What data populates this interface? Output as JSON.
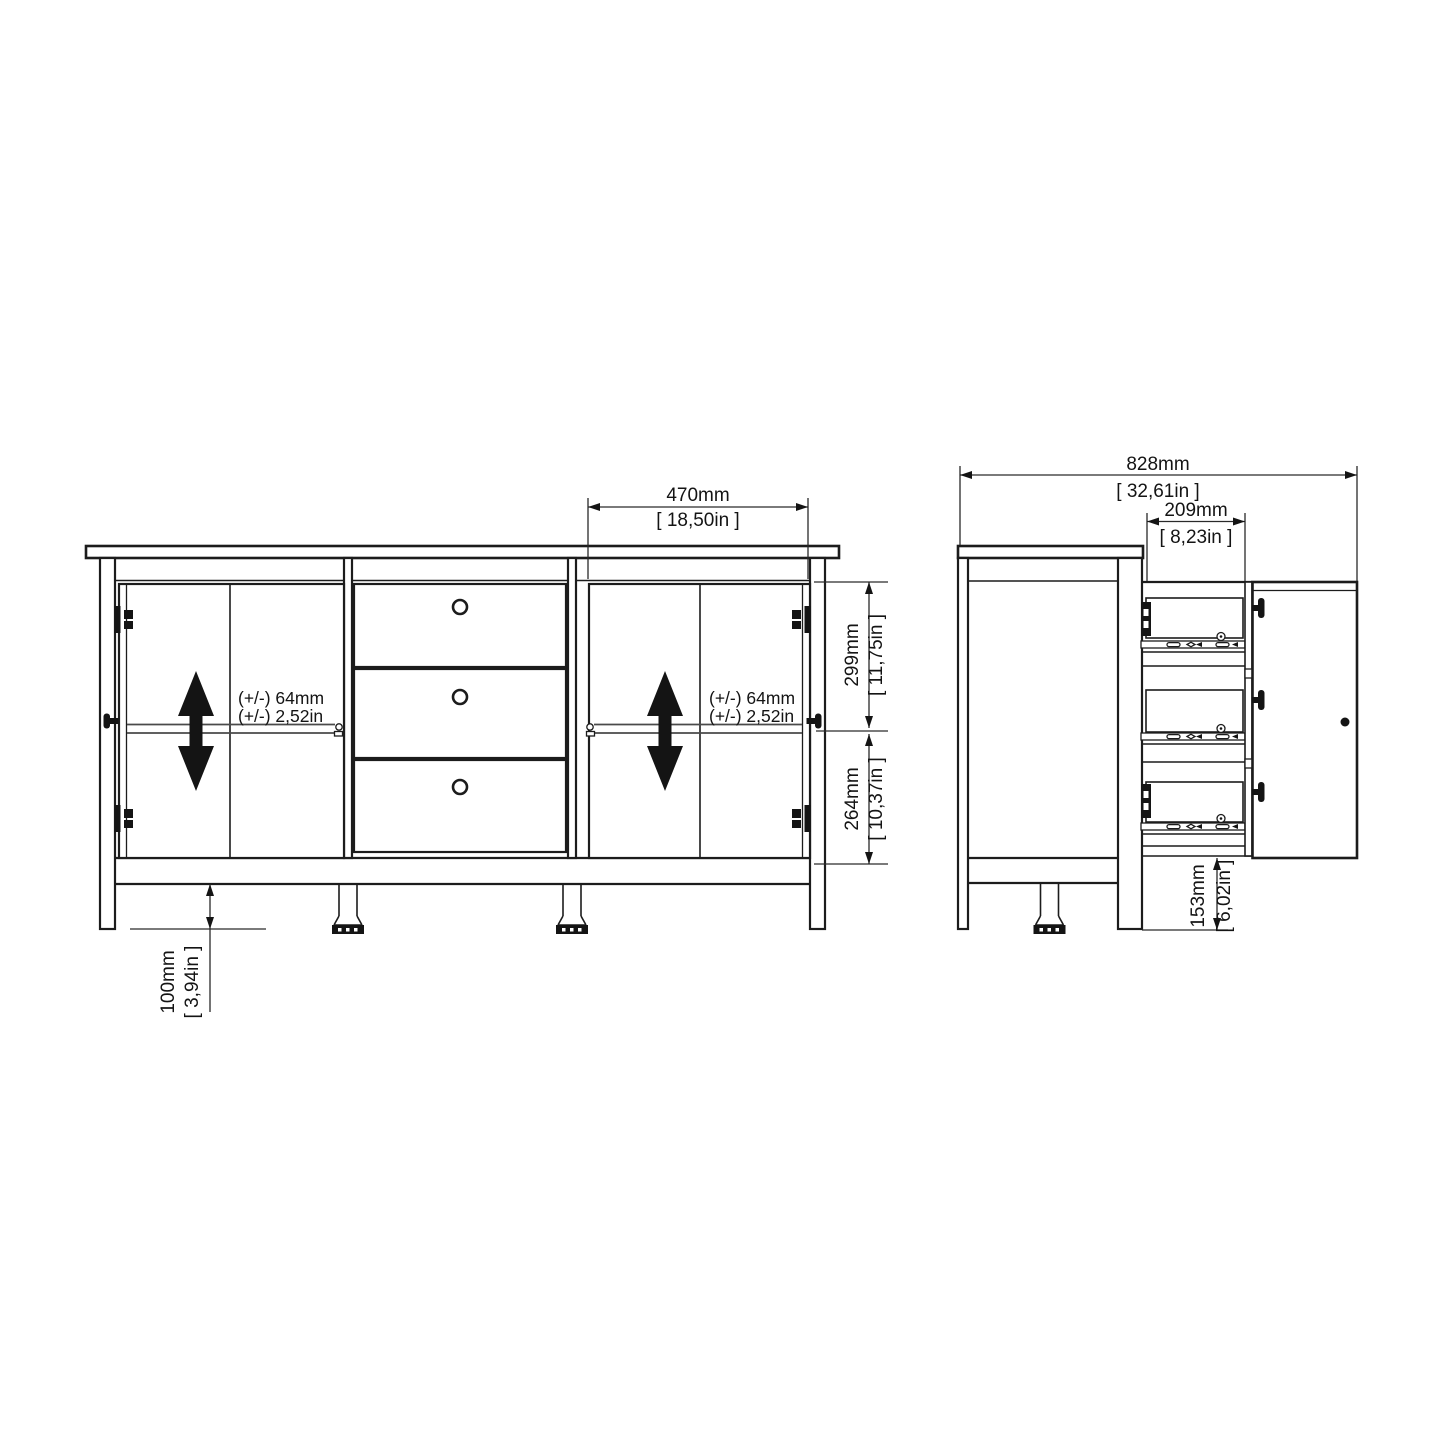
{
  "colors": {
    "background": "#ffffff",
    "line": "#1c1c1c"
  },
  "front_view": {
    "bay_width": {
      "mm": "470mm",
      "inch": "[ 18,50in ]"
    },
    "upper_height": {
      "mm": "299mm",
      "inch": "[ 11,75in ]"
    },
    "lower_height": {
      "mm": "264mm",
      "inch": "[ 10,37in ]"
    },
    "leg_height": {
      "mm": "100mm",
      "inch": "[ 3,94in ]"
    },
    "shelf_tolerance_left": {
      "line1": "(+/-) 64mm",
      "line2": "(+/-) 2,52in"
    },
    "shelf_tolerance_right": {
      "line1": "(+/-) 64mm",
      "line2": "(+/-) 2,52in"
    }
  },
  "side_view": {
    "open_depth": {
      "mm": "828mm",
      "inch": "[ 32,61in ]"
    },
    "drawer_depth": {
      "mm": "209mm",
      "inch": "[ 8,23in ]"
    },
    "floor_clearance": {
      "mm": "153mm",
      "inch": "[ 6,02in ]"
    }
  }
}
